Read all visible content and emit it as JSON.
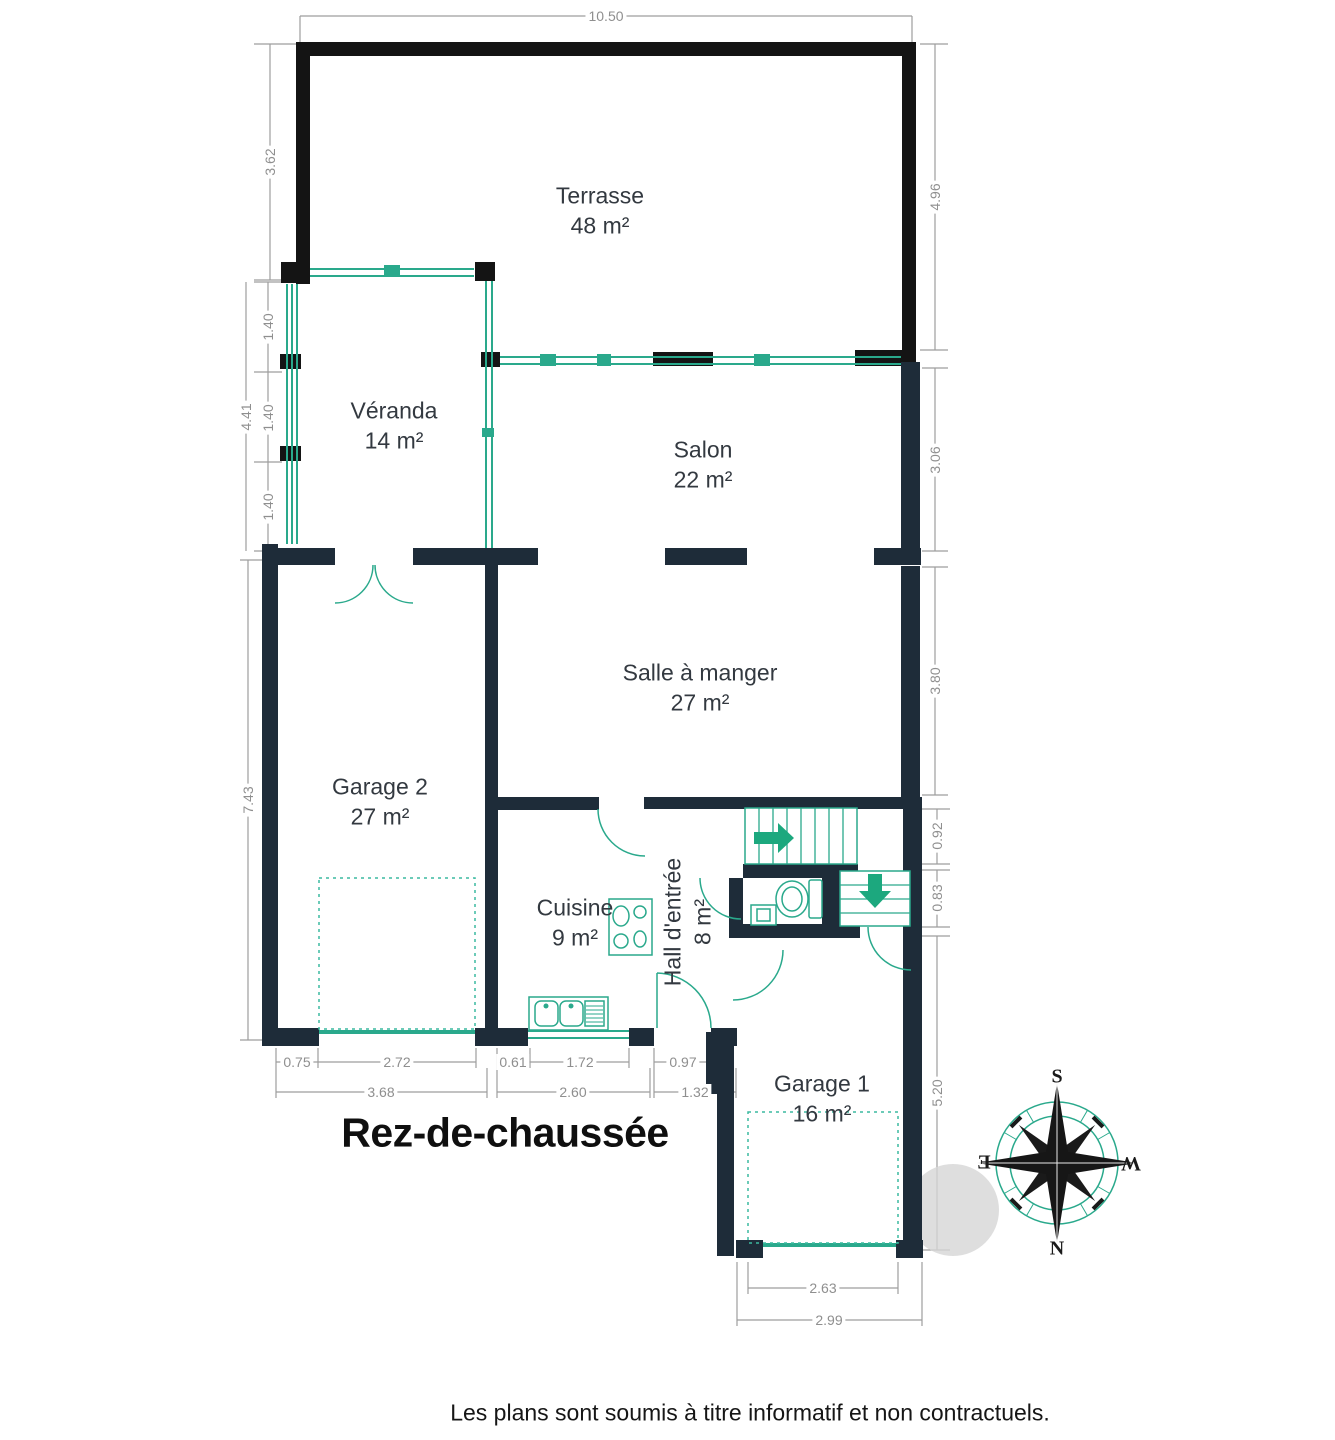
{
  "title": "Rez-de-chaussée",
  "disclaimer": "Les plans sont soumis à titre informatif et non contractuels.",
  "rooms": {
    "terrasse": {
      "name": "Terrasse",
      "area": "48 m²"
    },
    "veranda": {
      "name": "Véranda",
      "area": "14 m²"
    },
    "salon": {
      "name": "Salon",
      "area": "22 m²"
    },
    "salle_a_manger": {
      "name": "Salle à manger",
      "area": "27 m²"
    },
    "garage2": {
      "name": "Garage 2",
      "area": "27 m²"
    },
    "cuisine": {
      "name": "Cuisine",
      "area": "9 m²"
    },
    "hall": {
      "name": "Hall d'entrée",
      "area": "8 m²"
    },
    "garage1": {
      "name": "Garage 1",
      "area": "16 m²"
    }
  },
  "dims": {
    "top_width": "10.50",
    "terrace_left": "3.62",
    "terrace_right": "4.96",
    "veranda_seg1": "1.40",
    "veranda_seg2": "1.40",
    "veranda_seg3": "1.40",
    "veranda_total": "4.41",
    "salon_right": "3.06",
    "dining_right": "3.80",
    "garage2_left": "7.43",
    "stair_right": "0.92",
    "wc_right": "0.83",
    "garage1_right": "5.20",
    "garage2_offset": "0.75",
    "garage2_door": "2.72",
    "cuisine_offset": "0.61",
    "cuisine_window": "1.72",
    "entry_door": "0.97",
    "garage2_width": "3.68",
    "cuisine_width": "2.60",
    "hall_width": "1.32",
    "garage1_door": "2.63",
    "garage1_width": "2.99"
  },
  "compass": {
    "north": "N",
    "south": "S",
    "east": "E",
    "west": "W"
  },
  "colors": {
    "wall_navy": "#1e2c39",
    "wall_black": "#141414",
    "glass_teal": "#2aa98c",
    "arrow_green": "#1ca87e",
    "dim_gray": "#8f8f8f"
  }
}
